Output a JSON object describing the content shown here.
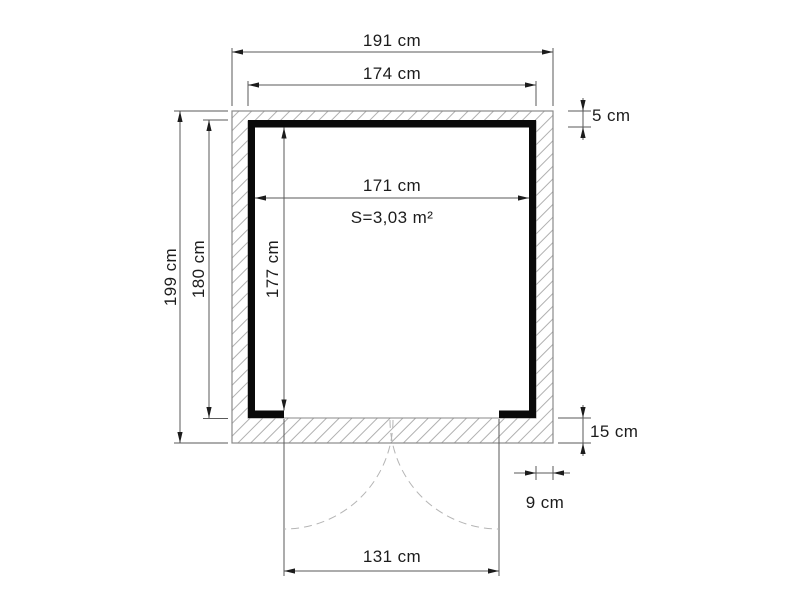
{
  "plan": {
    "kind": "shed-floor-plan",
    "unit": "cm",
    "area": {
      "label": "S=3,03 m²",
      "value_m2": 3.03
    },
    "dims": {
      "top_outer": {
        "label": "191 cm",
        "value": 191
      },
      "top_inner": {
        "label": "174 cm",
        "value": 174
      },
      "left_outer": {
        "label": "199 cm",
        "value": 199
      },
      "left_inner": {
        "label": "180 cm",
        "value": 180
      },
      "room_width": {
        "label": "171 cm",
        "value": 171
      },
      "room_depth": {
        "label": "177 cm",
        "value": 177
      },
      "right_top": {
        "label": "5 cm",
        "value": 5
      },
      "right_bottom": {
        "label": "15 cm",
        "value": 15
      },
      "side_small": {
        "label": "9 cm",
        "value": 9
      },
      "door_width": {
        "label": "131 cm",
        "value": 131
      }
    },
    "colors": {
      "background": "#ffffff",
      "wall": "#0a0a0a",
      "outline": "#8a8a8a",
      "hatch": "#b0b0b0",
      "interior": "#ffffff",
      "dimension_line": "#5a5a5a",
      "arrow": "#1c1c1c",
      "text": "#1c1c1c",
      "door_swing": "#b5b5b5"
    }
  }
}
